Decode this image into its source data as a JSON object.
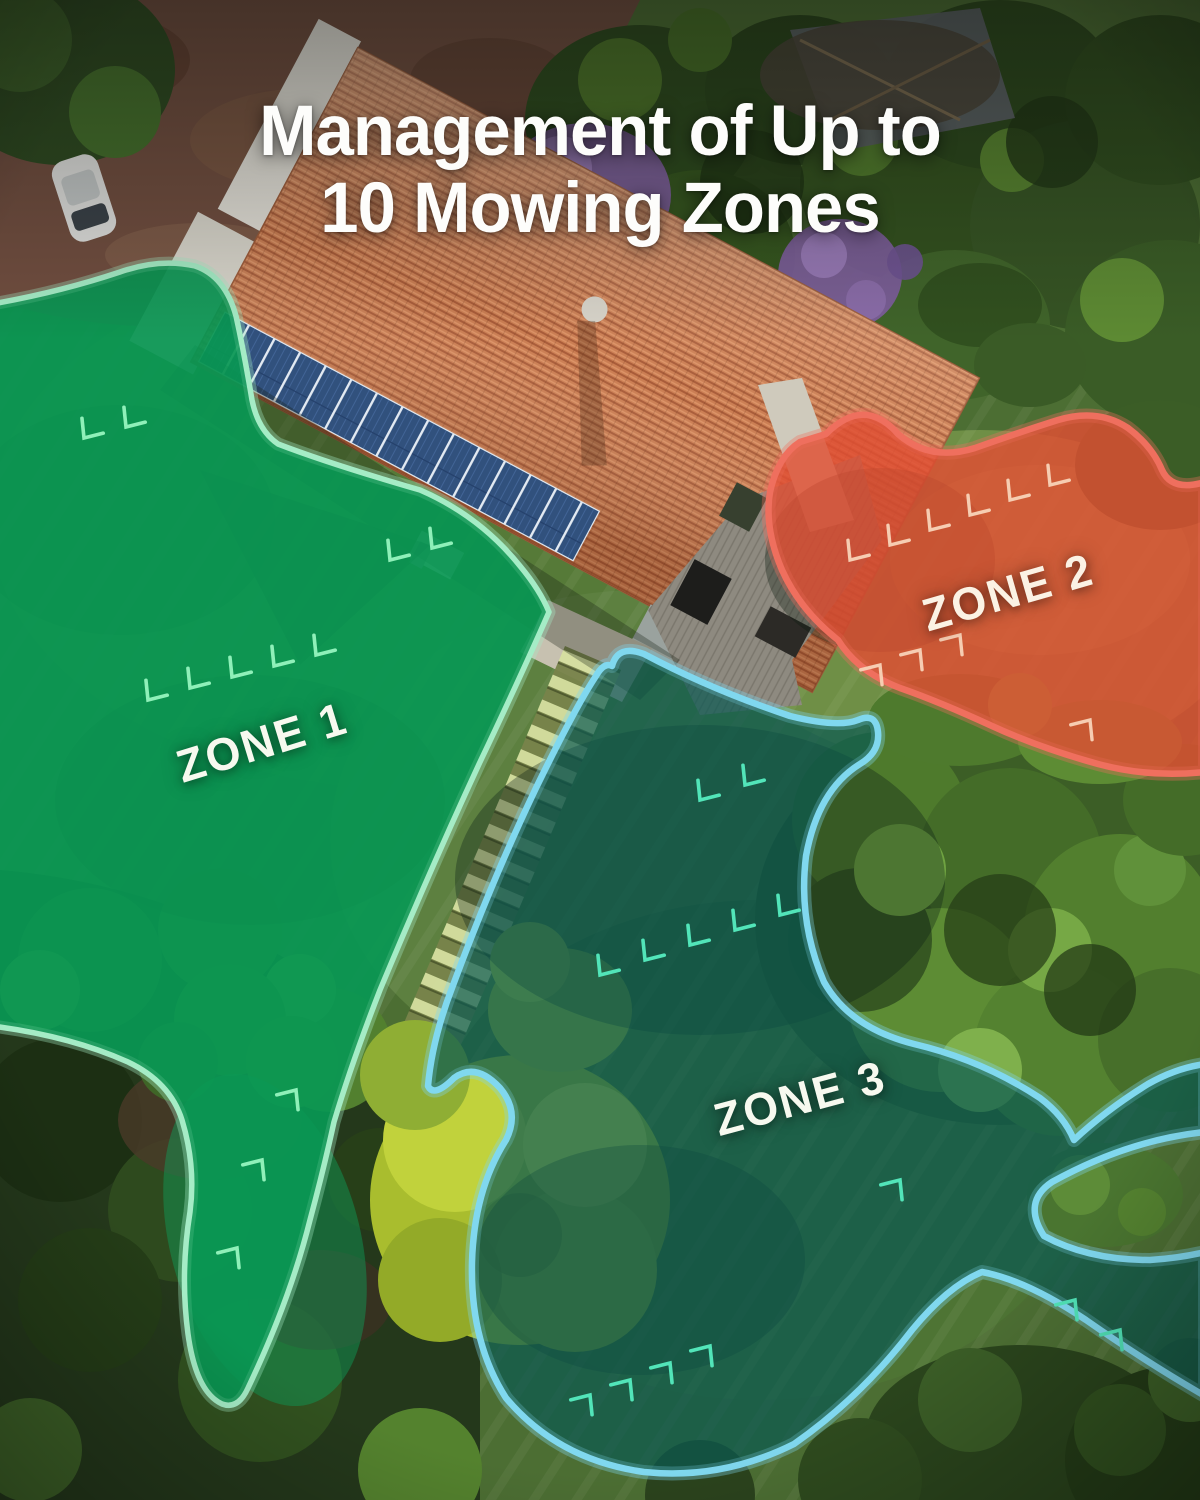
{
  "title": {
    "line1": "Management of Up to",
    "line2": "10 Mowing Zones"
  },
  "zones": [
    {
      "label": "ZONE 1",
      "fill": "rgba(10,152,84,0.55)",
      "hatch": "#82e6ac",
      "border": "#a5ecc6",
      "arrow": "#8ff0b9"
    },
    {
      "label": "ZONE 2",
      "fill": "rgba(226,78,52,0.33)",
      "hatch": "#f4c6ad",
      "border": "#ef6f5e",
      "arrow": "#f6cdb2"
    },
    {
      "label": "ZONE 3",
      "fill": "rgba(10,90,84,0.30)",
      "hatch": "#3ad2a8",
      "border": "#80d8ef",
      "arrow": "#52e5b9"
    }
  ],
  "scene": {
    "lawn": "#4c6e33",
    "driveway": "#714e40",
    "forest": "#24381b",
    "roof_tile": "#cb7e53",
    "solar_panel": "#31517d",
    "deck": "#8e8a80",
    "path_steps": "#d6dfa0",
    "flower_tree": "#7c5e9a",
    "yellow_tree": "#a9bd2e"
  }
}
